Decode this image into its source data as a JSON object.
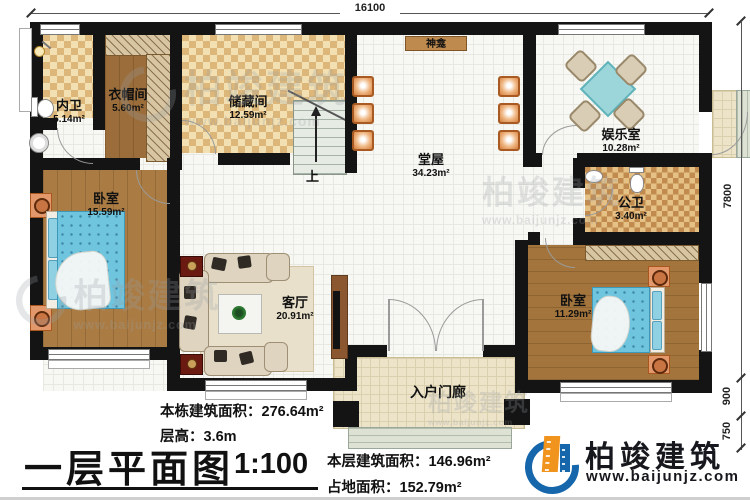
{
  "title": {
    "text": "一层平面图",
    "scale": "1:100"
  },
  "dimensions": {
    "top": "16100",
    "right_segments": [
      "7800",
      "900",
      "750"
    ]
  },
  "rooms": [
    {
      "name": "内卫",
      "area": "5.14m²"
    },
    {
      "name": "衣帽间",
      "area": "5.60m²"
    },
    {
      "name": "储藏间",
      "area": "12.59m²"
    },
    {
      "name": "卧室",
      "area": "15.59m²"
    },
    {
      "name": "堂屋",
      "area": "34.23m²"
    },
    {
      "name": "娱乐室",
      "area": "10.28m²"
    },
    {
      "name": "公卫",
      "area": "3.40m²"
    },
    {
      "name": "客厅",
      "area": "20.91m²"
    },
    {
      "name": "卧室",
      "area": "11.29m²"
    },
    {
      "name": "入户门廊",
      "area": ""
    }
  ],
  "labels": {
    "shrine": "神龛",
    "stairs_up": "上"
  },
  "stats": {
    "building_total": {
      "label": "本栋建筑面积：",
      "value": "276.64m²"
    },
    "floor_height": {
      "label": "层高：",
      "value": "3.6m"
    },
    "floor_area": {
      "label": "本层建筑面积：",
      "value": "146.96m²"
    },
    "land_area": {
      "label": "占地面积：",
      "value": "152.79m²"
    }
  },
  "branding": {
    "name": "柏竣建筑",
    "url": "www.baijunjz.com"
  },
  "watermark": {
    "name": "柏竣建筑",
    "url": "www.baijunjz.com"
  },
  "colors": {
    "wall": "#141414",
    "wood_floor": "#aa7c44",
    "checker_tan": "#ddb679",
    "bed_blue": "#6fc4de",
    "table_teal": "#9dd6da",
    "logo_blue": "#1566ab",
    "logo_orange": "#f0941d"
  }
}
